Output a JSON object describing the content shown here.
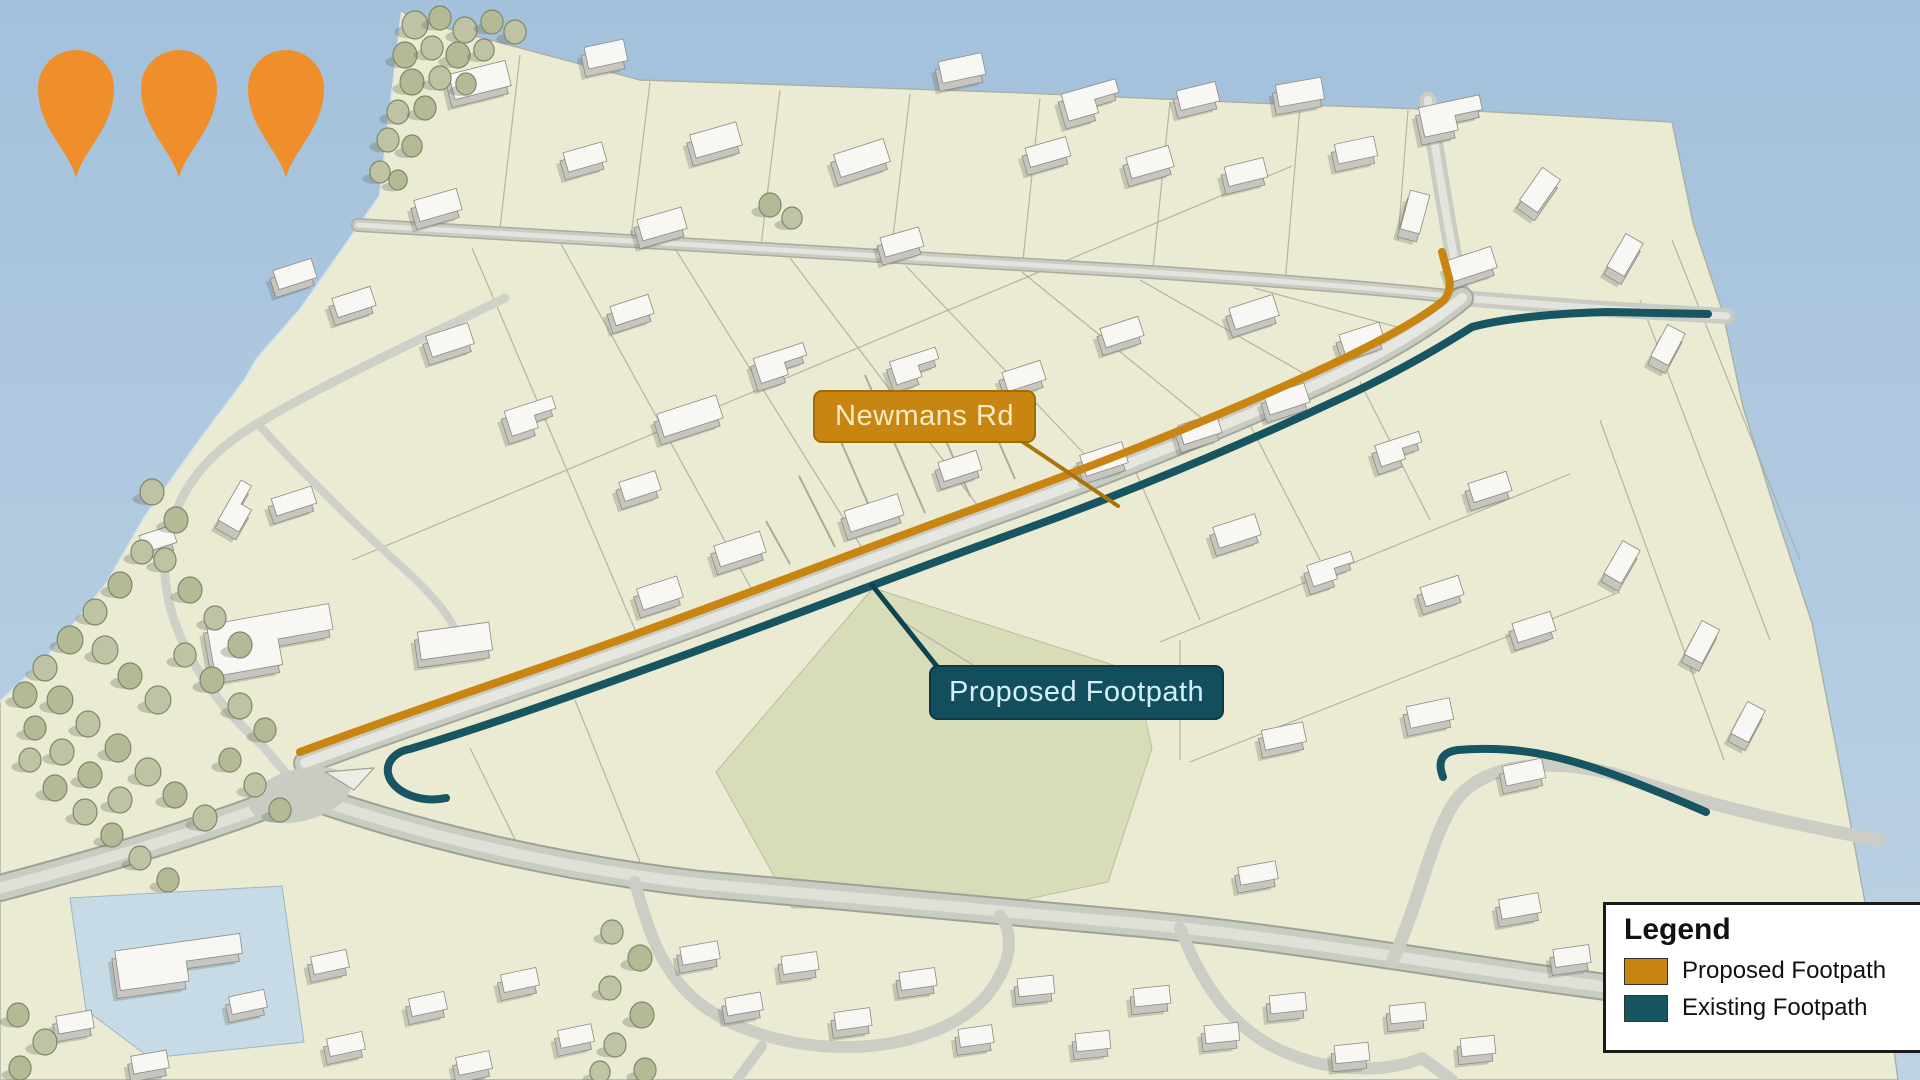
{
  "map": {
    "road_label": "Newmans Rd",
    "footpath_label": "Proposed Footpath"
  },
  "legend": {
    "title": "Legend",
    "items": [
      {
        "label": "Proposed Footpath",
        "swatch_color": "#C98511"
      },
      {
        "label": "Existing Footpath",
        "swatch_color": "#175563"
      }
    ],
    "marker_color": "#EE8F2B"
  },
  "colors": {
    "proposed_footpath": "#C98511",
    "existing_footpath": "#175563",
    "existing_footpath_label_bg": "#124E5C",
    "road_label_bg": "#C5820E",
    "marker_pin": "#EE8F2B",
    "sky": "#A6C3DC",
    "terrain": "#EAEBD2",
    "field": "#D9DCB9",
    "road": "#C9CCC3"
  }
}
